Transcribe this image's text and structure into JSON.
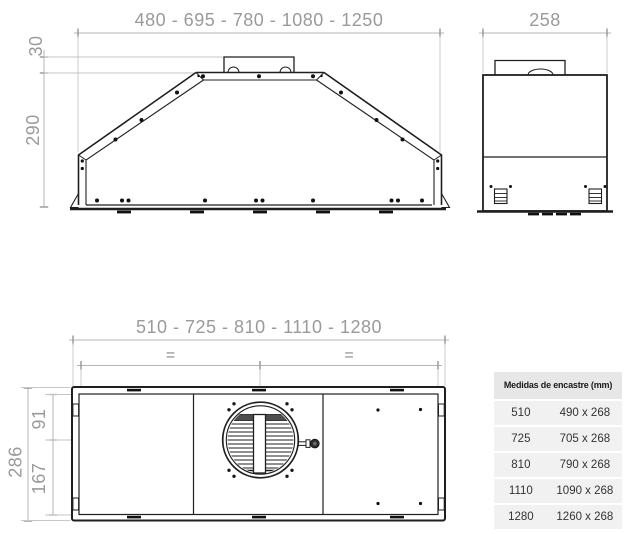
{
  "colors": {
    "drawing_line": "#1f1f1f",
    "dimension_text": "#9a9a9a",
    "dimension_line": "#b5b5b5",
    "table_header_bg": "#e7e7e7",
    "table_row_bg": "#f1f1f1",
    "background": "#ffffff"
  },
  "front_view": {
    "width_label": "480 - 695 - 780 - 1080 - 1250",
    "duct_height_label": "30",
    "body_height_label": "290"
  },
  "side_view": {
    "depth_label": "258"
  },
  "top_view": {
    "width_label": "510 - 725 - 810 - 1110 - 1280",
    "equal_symbol": "=",
    "inner_front_depth_label": "91",
    "inner_rear_depth_label": "167",
    "total_depth_label": "286"
  },
  "table": {
    "header": "Medidas de encastre (mm)",
    "rows": [
      {
        "width": "510",
        "cutout": "490 x 268"
      },
      {
        "width": "725",
        "cutout": "705 x 268"
      },
      {
        "width": "810",
        "cutout": "790 x 268"
      },
      {
        "width": "1110",
        "cutout": "1090 x 268"
      },
      {
        "width": "1280",
        "cutout": "1260 x 268"
      }
    ]
  }
}
